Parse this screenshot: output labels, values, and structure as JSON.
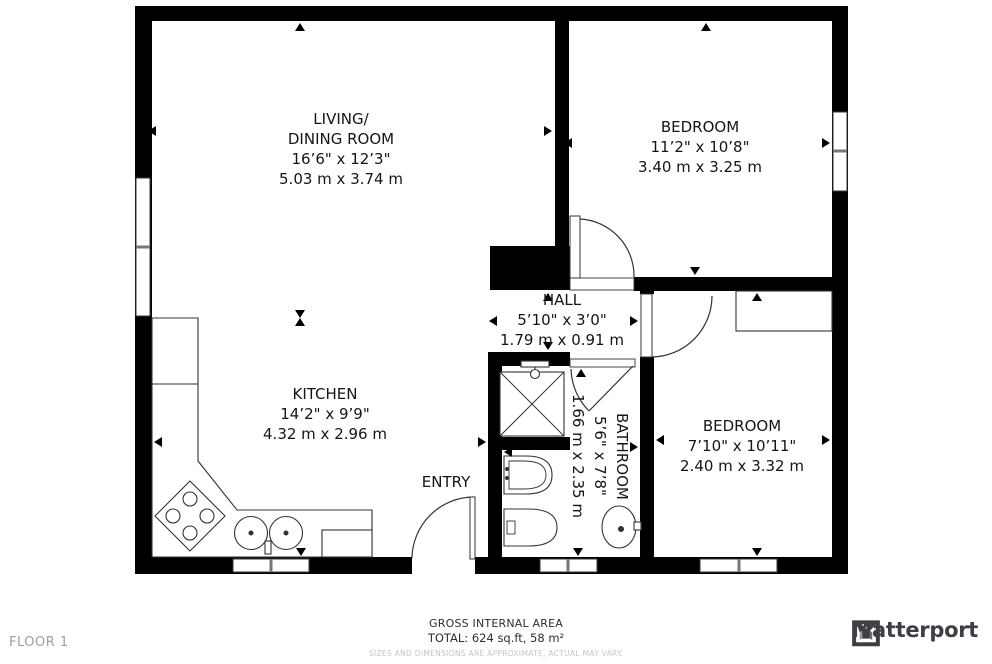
{
  "floor_label": "FLOOR 1",
  "rooms": {
    "living": {
      "name1": "LIVING/",
      "name2": "DINING ROOM",
      "imperial": "16’6\" x 12’3\"",
      "metric": "5.03 m x 3.74 m"
    },
    "bedroom1": {
      "name": "BEDROOM",
      "imperial": "11’2\" x 10’8\"",
      "metric": "3.40 m x 3.25 m"
    },
    "hall": {
      "name": "HALL",
      "imperial": "5’10\" x 3’0\"",
      "metric": "1.79 m x 0.91 m"
    },
    "kitchen": {
      "name": "KITCHEN",
      "imperial": "14’2\" x 9’9\"",
      "metric": "4.32 m x 2.96 m"
    },
    "bathroom": {
      "name": "BATHROOM",
      "imperial": "5’6\" x 7’8\"",
      "metric": "1.66 m x 2.35 m"
    },
    "bedroom2": {
      "name": "BEDROOM",
      "imperial": "7’10\" x 10’11\"",
      "metric": "2.40 m x 3.32 m"
    },
    "entry": {
      "name": "ENTRY"
    }
  },
  "footer": {
    "area_title": "GROSS INTERNAL AREA",
    "area_total": "TOTAL: 624 sq.ft, 58 m²",
    "disclaimer": "SIZES AND DIMENSIONS ARE APPROXIMATE, ACTUAL MAY VARY."
  },
  "brand": {
    "name": "Matterport"
  },
  "colors": {
    "wall": "#000000",
    "fixture_line": "#333333",
    "text": "#151515",
    "muted": "#9e9e9e",
    "faint": "#c6c6c6",
    "brand": "#3e3e45"
  }
}
